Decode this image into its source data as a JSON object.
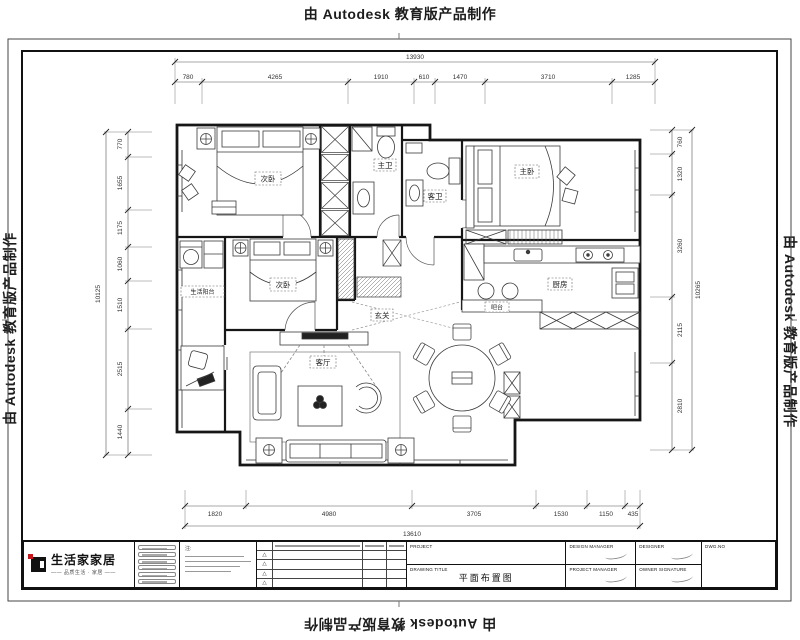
{
  "watermark": {
    "text": "由 Autodesk 教育版产品制作"
  },
  "dims": {
    "top": {
      "overall": "13930",
      "segs": [
        "780",
        "4265",
        "1910",
        "610",
        "1470",
        "3710",
        "1285"
      ]
    },
    "bottom": {
      "overall": "13610",
      "segs": [
        "1820",
        "4980",
        "3705",
        "1530",
        "1150",
        "435"
      ]
    },
    "left": {
      "overall": "10125",
      "segs": [
        "770",
        "1655",
        "1175",
        "1060",
        "1510",
        "2515",
        "1440"
      ]
    },
    "right": {
      "overall": "10265",
      "segs": [
        "760",
        "1320",
        "3260",
        "2115",
        "2810"
      ]
    }
  },
  "rooms": {
    "bedroom1": "次卧",
    "bath1": "主卫",
    "bath2": "客卫",
    "master": "主卧",
    "bedroom2": "次卧",
    "balcony": "生活阳台",
    "living": "客厅",
    "kitchen": "厨房",
    "bar": "吧台",
    "entry": "玄关"
  },
  "titleblock": {
    "brand": "生活家家居",
    "tagline": "—— 品质生活 · 家居 ——",
    "notes_label": "注:",
    "revision_marks": [
      "△",
      "△",
      "△",
      "△"
    ],
    "project_label": "PROJECT",
    "design_manager_label": "DESIGN MANAGER",
    "designer_label": "DESIGNER",
    "drawing_title_label": "DRAWING TITLE",
    "drawing_title": "平面布置图",
    "project_manager_label": "PROJECT MANAGER",
    "owner_signature_label": "OWNER SIGNATURE",
    "dwg_no_label": "DWG.NO"
  }
}
